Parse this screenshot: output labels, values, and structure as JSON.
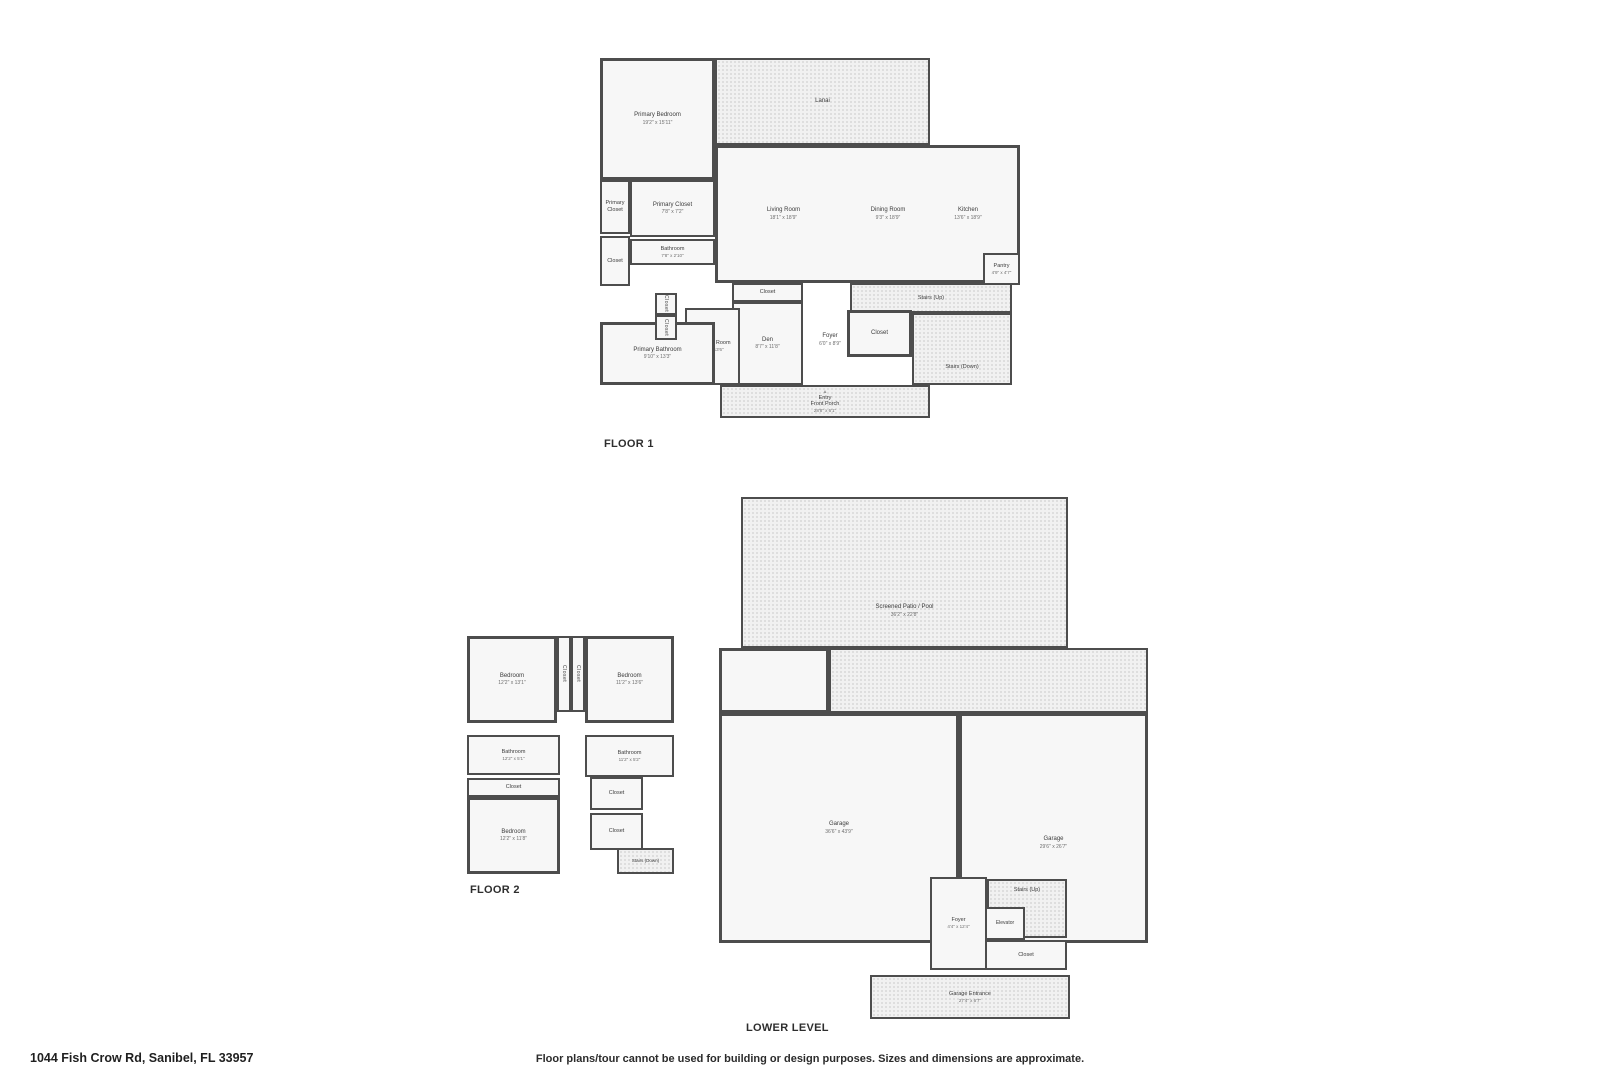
{
  "page": {
    "address": "1044 Fish Crow Rd, Sanibel, FL 33957",
    "disclaimer": "Floor plans/tour cannot be used for building or design purposes. Sizes and dimensions are approximate."
  },
  "colors": {
    "wall": "#4d4d4d",
    "room_fill": "#f7f7f7",
    "outdoor_fill": "#f1f1f1",
    "label_text": "#3c3c3c",
    "dims_text": "#6e6e6e"
  },
  "floor1": {
    "title": "FLOOR 1",
    "rooms": {
      "primary_bedroom": {
        "name": "Primary Bedroom",
        "dims": "19'2\" x 15'11\""
      },
      "lanai": {
        "name": "Lanai"
      },
      "living_room": {
        "name": "Living Room",
        "dims": "18'1\" x 18'9\""
      },
      "dining_room": {
        "name": "Dining Room",
        "dims": "9'3\" x 18'9\""
      },
      "kitchen": {
        "name": "Kitchen",
        "dims": "13'6\" x 18'9\""
      },
      "pantry": {
        "name": "Pantry",
        "dims": "4'9\" x 4'7\""
      },
      "primary_closet_small": {
        "name": "Primary Closet"
      },
      "primary_closet": {
        "name": "Primary Closet",
        "dims": "7'8\" x 7'2\""
      },
      "bathroom": {
        "name": "Bathroom",
        "dims": "7'8\" x 2'10\""
      },
      "closet_left": {
        "name": "Closet"
      },
      "closet_hall_1": {
        "name": "Closet"
      },
      "closet_hall_2": {
        "name": "Closet"
      },
      "laundry_room": {
        "name": "Laundry Room",
        "dims": "7'1\" x 13'6\""
      },
      "primary_bathroom": {
        "name": "Primary Bathroom",
        "dims": "9'10\" x 13'3\""
      },
      "den_closet": {
        "name": "Closet"
      },
      "den": {
        "name": "Den",
        "dims": "8'7\" x 11'8\""
      },
      "foyer": {
        "name": "Foyer",
        "dims": "6'0\" x 8'9\""
      },
      "stairs_up": {
        "name": "Stairs (Up)"
      },
      "stairs_closet": {
        "name": "Closet"
      },
      "stairs_down": {
        "name": "Stairs (Down)"
      },
      "entry": {
        "name": "Entry",
        "marker": "▲"
      },
      "front_porch": {
        "name": "Front Porch",
        "dims": "28'8\" x 6'1\""
      }
    }
  },
  "floor2": {
    "title": "FLOOR 2",
    "rooms": {
      "bedroom_left": {
        "name": "Bedroom",
        "dims": "12'2\" x 13'1\""
      },
      "closet_col_1": {
        "name": "Closet"
      },
      "closet_col_2": {
        "name": "Closet"
      },
      "bedroom_right": {
        "name": "Bedroom",
        "dims": "11'2\" x 13'6\""
      },
      "bathroom_left": {
        "name": "Bathroom",
        "dims": "12'2\" x 5'1\""
      },
      "bathroom_right": {
        "name": "Bathroom",
        "dims": "11'2\" x 5'2\""
      },
      "closet_mid": {
        "name": "Closet"
      },
      "bedroom_bottom": {
        "name": "Bedroom",
        "dims": "12'2\" x 11'8\""
      },
      "closet_right_1": {
        "name": "Closet"
      },
      "closet_right_2": {
        "name": "Closet"
      },
      "stairs_down": {
        "name": "Stairs (Down)"
      }
    }
  },
  "lower": {
    "title": "LOWER LEVEL",
    "rooms": {
      "screened_patio": {
        "name": "Screened Patio / Pool",
        "dims": "36'2\" x 22'8\""
      },
      "garage_left": {
        "name": "Garage",
        "dims": "36'6\" x 43'9\""
      },
      "garage_right": {
        "name": "Garage",
        "dims": "29'6\" x 26'7\""
      },
      "foyer": {
        "name": "Foyer",
        "dims": "4'4\" x 12'4\""
      },
      "elevator": {
        "name": "Elevator"
      },
      "stairs_up": {
        "name": "Stairs (Up)"
      },
      "closet": {
        "name": "Closet"
      },
      "garage_entrance": {
        "name": "Garage Entrance",
        "dims": "27'4\" x 6'7\""
      }
    }
  }
}
